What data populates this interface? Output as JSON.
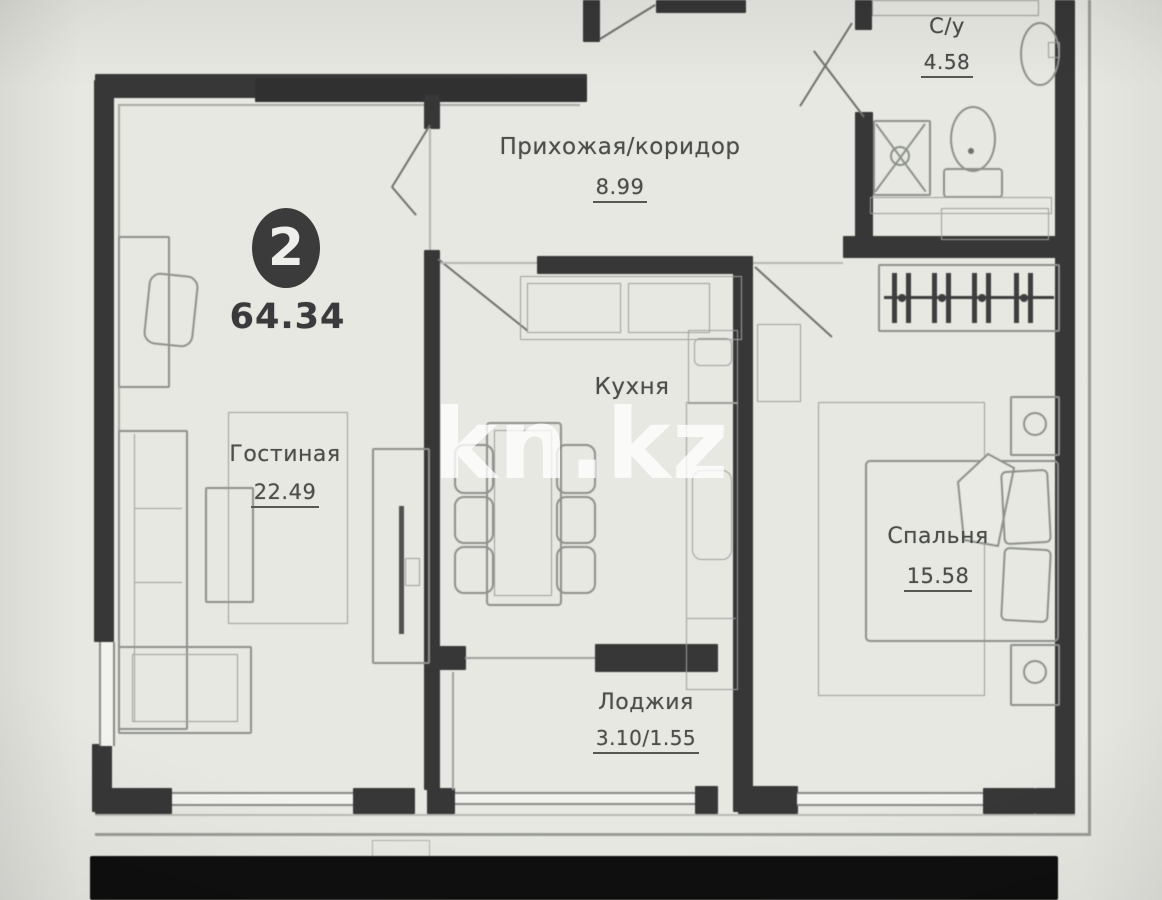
{
  "plan": {
    "type": "apartment floor plan",
    "badge": {
      "rooms_count": "2",
      "total_area": "64.34"
    },
    "rooms": {
      "hallway": {
        "name": "Прихожая/коридор",
        "area": "8.99"
      },
      "bathroom": {
        "name": "С/у",
        "area": "4.58"
      },
      "kitchen": {
        "name": "Кухня"
      },
      "living_room": {
        "name": "Гостиная",
        "area": "22.49"
      },
      "bedroom": {
        "name": "Спальня",
        "area": "15.58"
      },
      "loggia": {
        "name": "Лоджия",
        "area": "3.10/1.55"
      }
    },
    "watermark": "kn.kz",
    "colors": {
      "wall": "#373737",
      "paper": "#e7e8e2",
      "furniture_line": "#8e918b",
      "label_text": "#4c4e4b",
      "badge_bg": "#3b3b3b",
      "watermark": "rgba(255,255,255,0.78)"
    }
  }
}
